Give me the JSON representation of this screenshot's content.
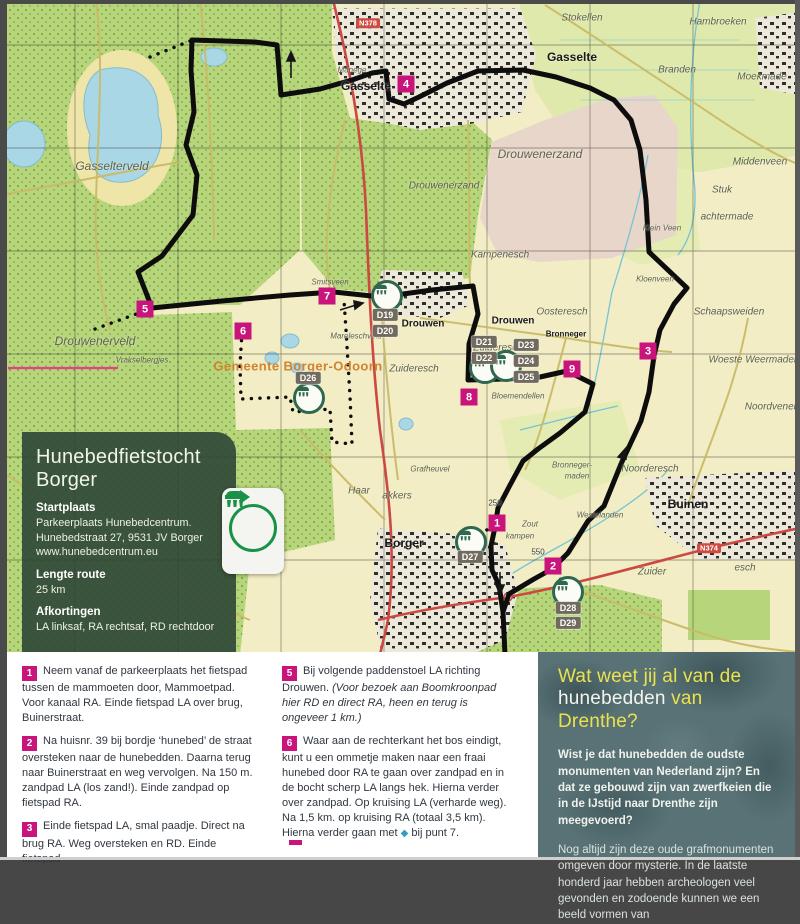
{
  "colors": {
    "accent_magenta": "#c9147c",
    "brand_green": "#1a9148",
    "title_yellow": "#ece24d",
    "panel_green": "#2a4234",
    "map_route": "#0d0d0d"
  },
  "info_panel": {
    "title": "Hunebedfietstocht Borger",
    "sections": [
      {
        "heading": "Startplaats",
        "l1": "Parkeerplaats Hunebedcentrum.",
        "l2": "Hunebedstraat 27, 9531 JV Borger",
        "l3": "www.hunebedcentrum.eu"
      },
      {
        "heading": "Lengte route",
        "l1": "25 km",
        "l2": "",
        "l3": ""
      },
      {
        "heading": "Afkortingen",
        "l1": "LA linksaf, RA rechtsaf, RD rechtdoor",
        "l2": "",
        "l3": ""
      }
    ]
  },
  "map": {
    "waypoints": [
      {
        "num": "1",
        "x": 497,
        "y": 523
      },
      {
        "num": "2",
        "x": 553,
        "y": 566
      },
      {
        "num": "3",
        "x": 648,
        "y": 351
      },
      {
        "num": "4",
        "x": 406,
        "y": 84
      },
      {
        "num": "5",
        "x": 145,
        "y": 309
      },
      {
        "num": "6",
        "x": 243,
        "y": 331
      },
      {
        "num": "7",
        "x": 327,
        "y": 296
      },
      {
        "num": "8",
        "x": 469,
        "y": 397
      },
      {
        "num": "9",
        "x": 572,
        "y": 369
      }
    ],
    "d_markers": [
      {
        "label": "D19",
        "x": 385,
        "y": 315
      },
      {
        "label": "D20",
        "x": 385,
        "y": 331
      },
      {
        "label": "D21",
        "x": 484,
        "y": 342
      },
      {
        "label": "D22",
        "x": 484,
        "y": 358
      },
      {
        "label": "D23",
        "x": 526,
        "y": 345
      },
      {
        "label": "D24",
        "x": 526,
        "y": 361
      },
      {
        "label": "D25",
        "x": 526,
        "y": 377
      },
      {
        "label": "D26",
        "x": 308,
        "y": 378
      },
      {
        "label": "D27",
        "x": 470,
        "y": 557
      },
      {
        "label": "D28",
        "x": 568,
        "y": 608
      },
      {
        "label": "D29",
        "x": 568,
        "y": 623
      }
    ],
    "hunebed_icons": [
      {
        "x": 387,
        "y": 296
      },
      {
        "x": 485,
        "y": 368
      },
      {
        "x": 506,
        "y": 366
      },
      {
        "x": 309,
        "y": 398
      },
      {
        "x": 471,
        "y": 542
      },
      {
        "x": 568,
        "y": 592
      }
    ],
    "road_shields": [
      {
        "label": "N374",
        "x": 709,
        "y": 548
      },
      {
        "label": "N378",
        "x": 368,
        "y": 23
      }
    ],
    "labels": [
      {
        "text": "Gasselterveld",
        "x": 112,
        "y": 166,
        "cls": "a big"
      },
      {
        "text": "Gasselte",
        "x": 366,
        "y": 86,
        "cls": "t big"
      },
      {
        "text": "Gasselte",
        "x": 572,
        "y": 57,
        "cls": "t big"
      },
      {
        "text": "Stokellen",
        "x": 582,
        "y": 18,
        "cls": "a"
      },
      {
        "text": "Hambroeken",
        "x": 718,
        "y": 22,
        "cls": "a"
      },
      {
        "text": "Branden",
        "x": 677,
        "y": 70,
        "cls": "a"
      },
      {
        "text": "Moekmade",
        "x": 762,
        "y": 77,
        "cls": "a"
      },
      {
        "text": "Middenveen",
        "x": 760,
        "y": 162,
        "cls": "a"
      },
      {
        "text": "Stuk",
        "x": 722,
        "y": 190,
        "cls": "a"
      },
      {
        "text": "achtermade",
        "x": 727,
        "y": 217,
        "cls": "a"
      },
      {
        "text": "Klein Veen",
        "x": 662,
        "y": 228,
        "cls": "a s"
      },
      {
        "text": "Kloenveen",
        "x": 655,
        "y": 279,
        "cls": "a s"
      },
      {
        "text": "Kampenesch",
        "x": 500,
        "y": 255,
        "cls": "a"
      },
      {
        "text": "Drouwenerzand",
        "x": 540,
        "y": 154,
        "cls": "a big"
      },
      {
        "text": "Drouwenerzand",
        "x": 444,
        "y": 186,
        "cls": "a"
      },
      {
        "text": "Drouwenerveld",
        "x": 95,
        "y": 341,
        "cls": "a big"
      },
      {
        "text": "Vrakselbergjes",
        "x": 142,
        "y": 360,
        "cls": "a s"
      },
      {
        "text": "Smitsveen",
        "x": 330,
        "y": 282,
        "cls": "a s"
      },
      {
        "text": "Mareleschveld",
        "x": 356,
        "y": 336,
        "cls": "a s"
      },
      {
        "text": "Gemeente Borger-Odoorn",
        "x": 298,
        "y": 366,
        "cls": "o"
      },
      {
        "text": "Drouwen",
        "x": 423,
        "y": 324,
        "cls": "t"
      },
      {
        "text": "Drouwen",
        "x": 513,
        "y": 321,
        "cls": "t"
      },
      {
        "text": "Oosteresch",
        "x": 562,
        "y": 312,
        "cls": "a"
      },
      {
        "text": "Bronneger",
        "x": 566,
        "y": 334,
        "cls": "t s"
      },
      {
        "text": "Zuideresch",
        "x": 414,
        "y": 369,
        "cls": "a"
      },
      {
        "text": "Zuideresch",
        "x": 498,
        "y": 348,
        "cls": "a"
      },
      {
        "text": "Bloemendellen",
        "x": 518,
        "y": 396,
        "cls": "a s"
      },
      {
        "text": "Schaapsweiden",
        "x": 729,
        "y": 312,
        "cls": "a"
      },
      {
        "text": "Woeste Weermaden",
        "x": 754,
        "y": 360,
        "cls": "a"
      },
      {
        "text": "Noordvenen",
        "x": 772,
        "y": 407,
        "cls": "a"
      },
      {
        "text": "Noorderesch",
        "x": 650,
        "y": 469,
        "cls": "a"
      },
      {
        "text": "Buinen",
        "x": 688,
        "y": 504,
        "cls": "t big"
      },
      {
        "text": "Borger",
        "x": 404,
        "y": 543,
        "cls": "t big"
      },
      {
        "text": "Haar",
        "x": 359,
        "y": 491,
        "cls": "a"
      },
      {
        "text": "akkers",
        "x": 397,
        "y": 496,
        "cls": "a"
      },
      {
        "text": "Zout",
        "x": 530,
        "y": 524,
        "cls": "a s"
      },
      {
        "text": "kampen",
        "x": 520,
        "y": 536,
        "cls": "a s"
      },
      {
        "text": "Westelanden",
        "x": 600,
        "y": 515,
        "cls": "a s"
      },
      {
        "text": "Bronneger-",
        "x": 572,
        "y": 465,
        "cls": "a s"
      },
      {
        "text": "maden",
        "x": 577,
        "y": 476,
        "cls": "a s"
      },
      {
        "text": "Zuider",
        "x": 652,
        "y": 572,
        "cls": "a"
      },
      {
        "text": "esch",
        "x": 745,
        "y": 568,
        "cls": "a"
      },
      {
        "text": "Grafheuvel",
        "x": 430,
        "y": 469,
        "cls": "a s"
      },
      {
        "text": "Manege",
        "x": 352,
        "y": 70,
        "cls": "a s"
      },
      {
        "text": "250",
        "x": 495,
        "y": 503,
        "cls": "n"
      },
      {
        "text": "550",
        "x": 538,
        "y": 552,
        "cls": "n"
      }
    ]
  },
  "instructions": {
    "col1": [
      {
        "num": "1",
        "text": "Neem vanaf de parkeerplaats het fietspad tussen de mammoeten door, Mammoetpad. Voor kanaal RA. Einde fietspad LA over brug, Buinerstraat.",
        "italic": "",
        "diamond": "",
        "text2": ""
      },
      {
        "num": "2",
        "text": "Na huisnr. 39 bij bordje ‘hunebed’ de straat oversteken naar de hunebedden. Daarna terug naar Buinerstraat en weg vervolgen. Na 150 m. zandpad LA (los zand!). Einde zandpad op fietspad RA.",
        "italic": "",
        "diamond": "",
        "text2": ""
      },
      {
        "num": "3",
        "text": "Einde fietspad LA, smal paadje. Direct na brug RA. Weg oversteken en RD. Einde fietspad",
        "italic": "",
        "diamond": "",
        "text2": ""
      }
    ],
    "col2": [
      {
        "num": "5",
        "text": "Bij volgende paddenstoel LA richting Drouwen. ",
        "italic": "(Voor bezoek aan Boomkroonpad hier RD en direct RA, heen en terug is ongeveer 1 km.)",
        "diamond": "",
        "text2": ""
      },
      {
        "num": "6",
        "text": "Waar aan de rechterkant het bos eindigt, kunt u een ommetje maken naar een fraai hunebed door RA te gaan over zandpad en in de bocht scherp LA langs hek. Hierna verder over zandpad. Op kruising LA (verharde weg). Na 1,5 km. op kruising RA (totaal 3,5 km). Hierna verder gaan met ",
        "italic": "",
        "diamond": "◆",
        "text2": " bij punt 7."
      }
    ]
  },
  "sidebar": {
    "title_line1": "Wat weet jij al van de",
    "title_white": "hunebedden",
    "title_yellow_end": " van Drenthe?",
    "para1": "Wist je dat hunebedden de oudste monumenten van Nederland zijn? En dat ze gebouwd zijn van zwerfkeien die in de IJstijd naar Drenthe zijn meegevoerd?",
    "para2": "Nog altijd zijn deze oude grafmonumenten omgeven door mysterie. In de laatste honderd jaar hebben archeologen veel gevonden en zodoende kunnen we een beeld vormen van"
  }
}
